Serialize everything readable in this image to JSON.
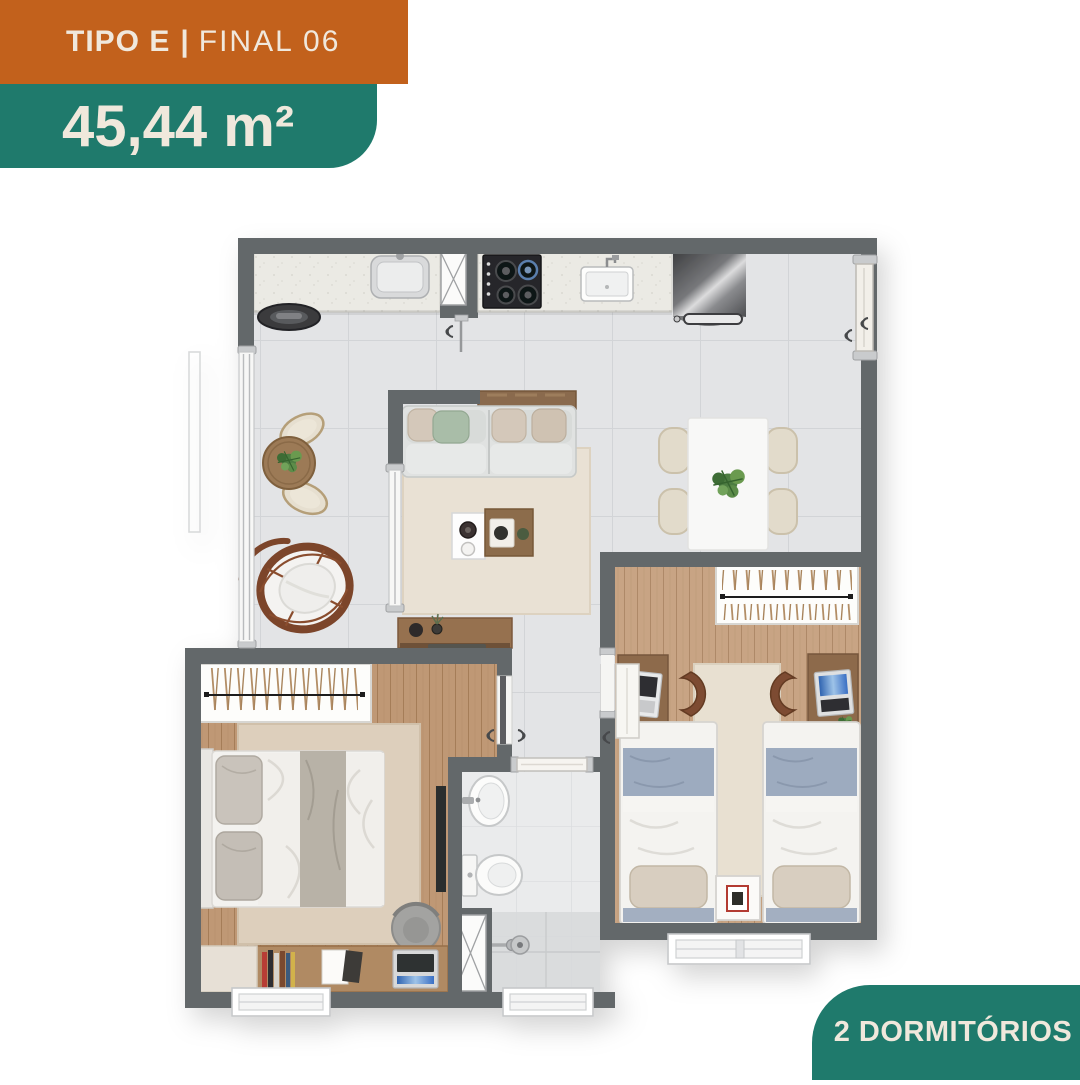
{
  "labels": {
    "type": "TIPO E",
    "divider": "|",
    "final": "FINAL 06",
    "area": "45,44 m²",
    "badge": "2 DORMITÓRIOS"
  },
  "colors": {
    "orange": "#c2611c",
    "teal": "#1f7a6c",
    "cream": "#f0e8dc",
    "wall": "#64676b",
    "tile_floor": "#e3e4e6",
    "wood_floor": "#c49e7b",
    "rug": "#e8e0d1",
    "blanket_blue": "#9dabbf"
  },
  "floor_plan": {
    "type": "apartment-floor-plan-top-view",
    "bedrooms": 2,
    "icons": [
      "kitchen-sink",
      "service-sink",
      "cooktop",
      "refrigerator",
      "washer",
      "shaft",
      "dining-table",
      "dining-chair",
      "plant",
      "sofa",
      "coffee-table",
      "sideboard",
      "bistro-table",
      "hanging-chair",
      "wardrobe",
      "double-bed",
      "tv",
      "desk",
      "office-chair",
      "books",
      "laptop",
      "single-bed",
      "nightstand",
      "bathroom-sink",
      "toilet",
      "shower",
      "window",
      "door"
    ]
  }
}
